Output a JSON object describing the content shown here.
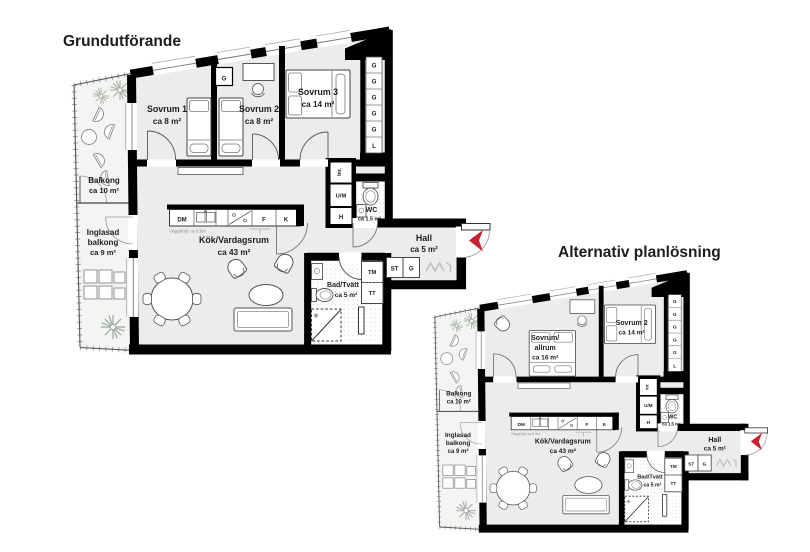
{
  "plan1": {
    "title": "Grundutförande",
    "rooms": {
      "sovrum1": {
        "name": "Sovrum 1",
        "area": "ca 8 m²"
      },
      "sovrum2": {
        "name": "Sovrum 2",
        "area": "ca 8 m²"
      },
      "sovrum3": {
        "name": "Sovrum 3",
        "area": "ca 14 m²"
      },
      "balkong": {
        "name": "Balkong",
        "area": "ca 10 m²"
      },
      "inglasad": {
        "line1": "Inglasad",
        "line2": "balkong",
        "area": "ca 9 m²"
      },
      "kok": {
        "name": "Kök/Vardagsrum",
        "area": "ca 43 m²"
      },
      "hall": {
        "name": "Hall",
        "area": "ca 5 m²"
      },
      "bad": {
        "name": "Bad/Tvätt",
        "area": "ca 5 m²"
      },
      "wc": {
        "name": "WC",
        "area": "ca 1.5 m²"
      }
    }
  },
  "plan2": {
    "title": "Alternativ planlösning",
    "rooms": {
      "sovrum_allrum": {
        "line1": "Sovrum/",
        "line2": "allrum",
        "area": "ca 16 m²"
      },
      "sovrum2": {
        "name": "Sovrum 2",
        "area": "ca 14 m²"
      },
      "balkong": {
        "name": "Balkong",
        "area": "ca 10 m²"
      },
      "inglasad": {
        "line1": "Inglasad",
        "line2": "balkong",
        "area": "ca 9 m²"
      },
      "kok": {
        "name": "Kök/Vardagsrum",
        "area": "ca 43 m²"
      },
      "hall": {
        "name": "Hall",
        "area": "ca 5 m²"
      },
      "bad": {
        "name": "Bad/Tvätt",
        "area": "ca 5 m²"
      },
      "wc": {
        "name": "WC",
        "area": "ca 1.5 m²"
      }
    }
  },
  "fixtures": {
    "dm": "DM",
    "f": "F",
    "k": "K",
    "um": "U/M",
    "h": "H",
    "tm": "TM",
    "tt": "TT",
    "st": "ST",
    "g": "G",
    "inr": "Inr.",
    "wall_note": "Vägghöjd ca 0.9m"
  },
  "closet_column": [
    "G",
    "G",
    "G",
    "G",
    "G",
    "L"
  ],
  "colors": {
    "wall": "#000000",
    "room_fill": "#ececec",
    "balcony_fill": "#f4f4f2",
    "accent_red": "#c9202f"
  }
}
